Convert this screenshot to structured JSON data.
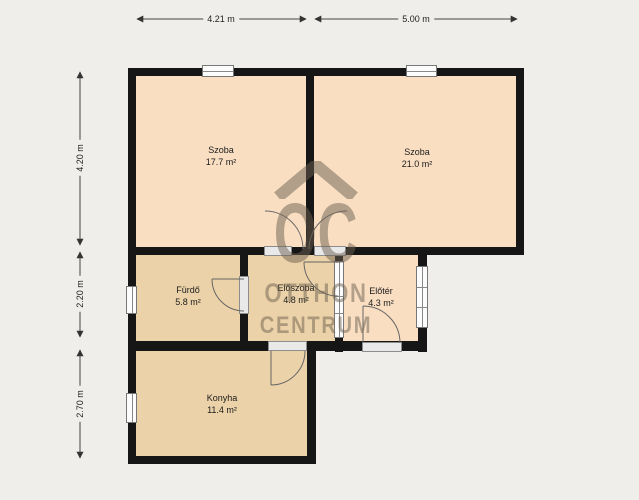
{
  "plan": {
    "type": "floor-plan",
    "background_color": "#efeeea",
    "wall_color": "#161616",
    "room_color_warm": "#f9dec1",
    "room_color_tan": "#ebd2a8",
    "watermark_color": "#6e6152"
  },
  "rooms": [
    {
      "name": "Szoba",
      "area": "17.7 m²"
    },
    {
      "name": "Szoba",
      "area": "21.0 m²"
    },
    {
      "name": "Fürdő",
      "area": "5.8 m²"
    },
    {
      "name": "Előszoba",
      "area": "4.8 m²"
    },
    {
      "name": "Előtér",
      "area": "4.3 m²"
    },
    {
      "name": "Konyha",
      "area": "11.4 m²"
    }
  ],
  "dimensions": {
    "top": [
      {
        "label": "4.21 m"
      },
      {
        "label": "5.00 m"
      }
    ],
    "left": [
      {
        "label": "4.20 m"
      },
      {
        "label": "2.20 m"
      },
      {
        "label": "2.70 m"
      }
    ]
  },
  "watermark": {
    "line1": "OC",
    "line2": "OTTHON",
    "line3": "CENTRUM"
  }
}
